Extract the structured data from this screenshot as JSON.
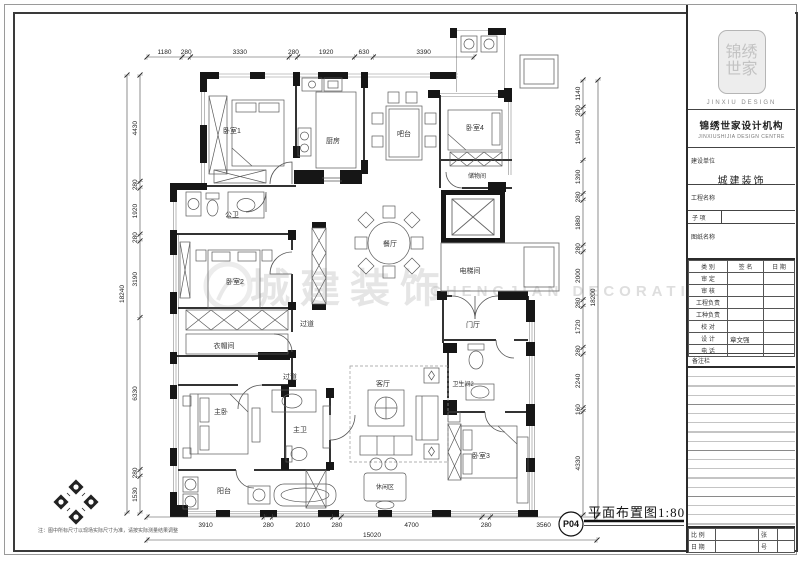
{
  "sheet": {
    "drawing_number": "P04",
    "drawing_title": "平面布置图1:80",
    "note": "注：图中所标尺寸以现场实际尺寸为准，请按实际测量结果调整",
    "watermark_cn": "城建装饰",
    "watermark_en": "CHENGJIAN DECORATION"
  },
  "rooms": {
    "bedroom1": "卧室1",
    "kitchen": "厨房",
    "bar": "吧台",
    "bedroom4": "卧室4",
    "storage": "储物间",
    "public_bath": "公卫",
    "dining": "餐厅",
    "elevator": "电梯间",
    "bedroom2": "卧室2",
    "corridor1": "过道",
    "cloakroom": "衣帽间",
    "corridor2": "过道",
    "foyer": "门厅",
    "master_bedroom": "主卧",
    "master_bath": "主卫",
    "living": "客厅",
    "bathroom2": "卫生间2",
    "leisure": "休闲区",
    "bedroom3": "卧室3",
    "balcony": "阳台"
  },
  "dimensions": {
    "top": [
      1180,
      280,
      3330,
      280,
      1920,
      630,
      3390
    ],
    "left": [
      4430,
      280,
      1920,
      280,
      3190,
      6330,
      280,
      1530
    ],
    "left_total": 18240,
    "right": [
      1140,
      280,
      1940,
      1390,
      280,
      1880,
      280,
      2000,
      280,
      1720,
      280,
      2240,
      160,
      4330
    ],
    "right_total": 18200,
    "bottom": [
      3910,
      280,
      2010,
      280,
      4700,
      280,
      3560
    ],
    "bottom_total": 15020
  },
  "title_block": {
    "logo_text": "锦绣世家",
    "logo_caption": "JINXIU DESIGN",
    "org_cn": "锦绣世家设计机构",
    "org_en": "JINXIUSHIJIA DESIGN CENTRE",
    "client_label": "建设单位",
    "client_value": "城建装饰",
    "project_label": "工程名称",
    "subitem_label": "子  项",
    "drawing_name_label": "图纸名称",
    "sign_table": {
      "headers": [
        "类 别",
        "签  名",
        "日 期"
      ],
      "rows": [
        {
          "label": "审  定",
          "value": ""
        },
        {
          "label": "审  核",
          "value": ""
        },
        {
          "label": "工程负责",
          "value": ""
        },
        {
          "label": "工种负责",
          "value": ""
        },
        {
          "label": "校  对",
          "value": ""
        },
        {
          "label": "设  计",
          "value": "章文强"
        },
        {
          "label": "电  话",
          "value": ""
        }
      ]
    },
    "remarks_label": "备注栏",
    "scale_label": "比  例",
    "sheet_label": "张",
    "date_label": "日  期",
    "number_label": "号"
  }
}
